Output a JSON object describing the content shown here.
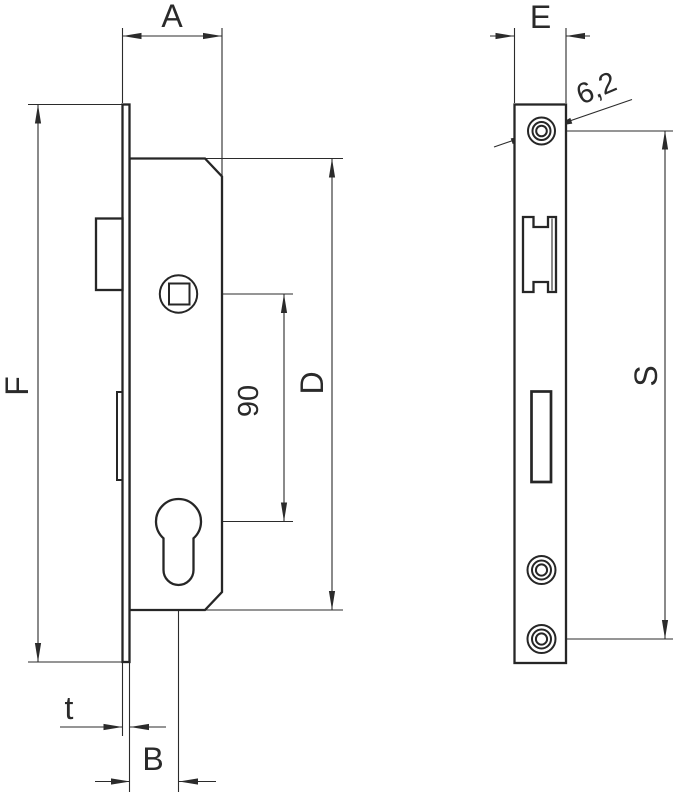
{
  "drawing": {
    "type": "technical-drawing-mortise-lock",
    "colors": {
      "line": "#262626",
      "dimension_line": "#2b2b2b",
      "background": "#ffffff"
    },
    "labels": {
      "A": "A",
      "E": "E",
      "F": "F",
      "D": "D",
      "S": "S",
      "B": "B",
      "t": "t",
      "follower_to_cylinder": "90",
      "screw_hole_diameter": "6,2"
    }
  }
}
